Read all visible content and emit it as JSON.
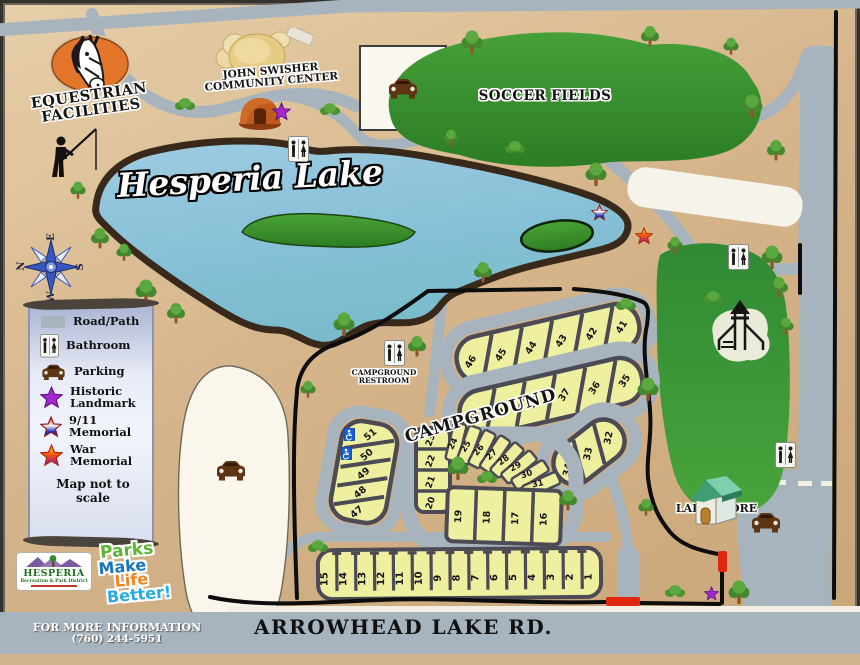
{
  "labels": {
    "equestrian_line1": "EQUESTRIAN",
    "equestrian_line2": "FACILITIES",
    "community_line1": "JOHN SWISHER",
    "community_line2": "COMMUNITY CENTER",
    "soccer": "SOCCER FIELDS",
    "lake": "Hesperia Lake",
    "campground": "CAMPGROUND",
    "restroom_line1": "CAMPGROUND",
    "restroom_line2": "RESTROOM",
    "lake_store": "LAKE STORE",
    "road": "ARROWHEAD LAKE RD.",
    "info_line1": "FOR MORE INFORMATION",
    "info_line2": "(760) 244-5951"
  },
  "legend": {
    "items": [
      {
        "icon": "road-swatch",
        "label": "Road/Path",
        "label2": ""
      },
      {
        "icon": "bathroom-icon",
        "label": "Bathroom",
        "label2": ""
      },
      {
        "icon": "parking-car-icon",
        "label": "Parking",
        "label2": ""
      },
      {
        "icon": "historic-landmark-star-icon",
        "label": "Historic",
        "label2": "Landmark"
      },
      {
        "icon": "911-memorial-star-icon",
        "label": "9/11",
        "label2": "Memorial"
      },
      {
        "icon": "war-memorial-star-icon",
        "label": "War",
        "label2": "Memorial"
      }
    ],
    "note": "Map not to scale"
  },
  "compass": {
    "n": "N",
    "e": "E",
    "s": "S",
    "w": "W"
  },
  "logos": {
    "hesperia_title": "HESPERIA",
    "hesperia_sub": "Recreation & Park District",
    "parks_line1": "Parks",
    "parks_line2": "Make",
    "parks_line3": "Life",
    "parks_line4": "Better!"
  },
  "campsites": {
    "row_41_46": [
      46,
      45,
      44,
      43,
      42,
      41
    ],
    "row_35_40": [
      40,
      39,
      38,
      37,
      36,
      35
    ],
    "row_32_34": [
      34,
      33,
      32
    ],
    "loop_left": [
      23,
      22,
      21,
      20
    ],
    "loop_arc": [
      24,
      25,
      26,
      27,
      28,
      29,
      30,
      31
    ],
    "loop_bottom": [
      19,
      18,
      17,
      16
    ],
    "left_block": [
      51,
      50,
      49,
      48,
      47
    ],
    "front_row": [
      15,
      14,
      13,
      12,
      11,
      10,
      9,
      8,
      7,
      6,
      5,
      4,
      3,
      2,
      1
    ]
  },
  "map_features": {
    "trees": [
      [
        472,
        42
      ],
      [
        650,
        36
      ],
      [
        731,
        46
      ],
      [
        752,
        106
      ],
      [
        776,
        150
      ],
      [
        451,
        138
      ],
      [
        596,
        174
      ],
      [
        483,
        272
      ],
      [
        675,
        245
      ],
      [
        772,
        257
      ],
      [
        779,
        287
      ],
      [
        786,
        326
      ],
      [
        648,
        389
      ],
      [
        100,
        238
      ],
      [
        124,
        252
      ],
      [
        146,
        291
      ],
      [
        176,
        313
      ],
      [
        78,
        190
      ],
      [
        344,
        324
      ],
      [
        417,
        346
      ],
      [
        308,
        389
      ],
      [
        458,
        468
      ],
      [
        568,
        500
      ],
      [
        646,
        507
      ],
      [
        739,
        592
      ]
    ],
    "bushes": [
      [
        185,
        104
      ],
      [
        330,
        109
      ],
      [
        515,
        147
      ],
      [
        487,
        477
      ],
      [
        318,
        546
      ],
      [
        675,
        591
      ],
      [
        713,
        297
      ],
      [
        626,
        304
      ]
    ],
    "bathrooms": [
      [
        288,
        136
      ],
      [
        384,
        340
      ],
      [
        728,
        244
      ],
      [
        775,
        442
      ]
    ],
    "cars": [
      [
        386,
        78
      ],
      [
        214,
        460
      ],
      [
        749,
        512
      ]
    ],
    "historic_stars": [
      [
        272,
        102,
        19
      ],
      [
        704,
        586,
        15
      ]
    ],
    "memorial_911_stars": [
      [
        591,
        204,
        17
      ]
    ],
    "war_memorial_stars": [
      [
        635,
        227,
        18
      ]
    ],
    "handicap": [
      [
        344,
        428
      ],
      [
        341,
        447
      ]
    ]
  },
  "colors": {
    "road": "#a7b4bd",
    "lake": "#8ec6de",
    "field_green": "#3d9434",
    "site_yellow": "#eef0a0",
    "tan": "#d3b188",
    "purple_star": "#a428d0",
    "gate_red": "#e02810"
  }
}
